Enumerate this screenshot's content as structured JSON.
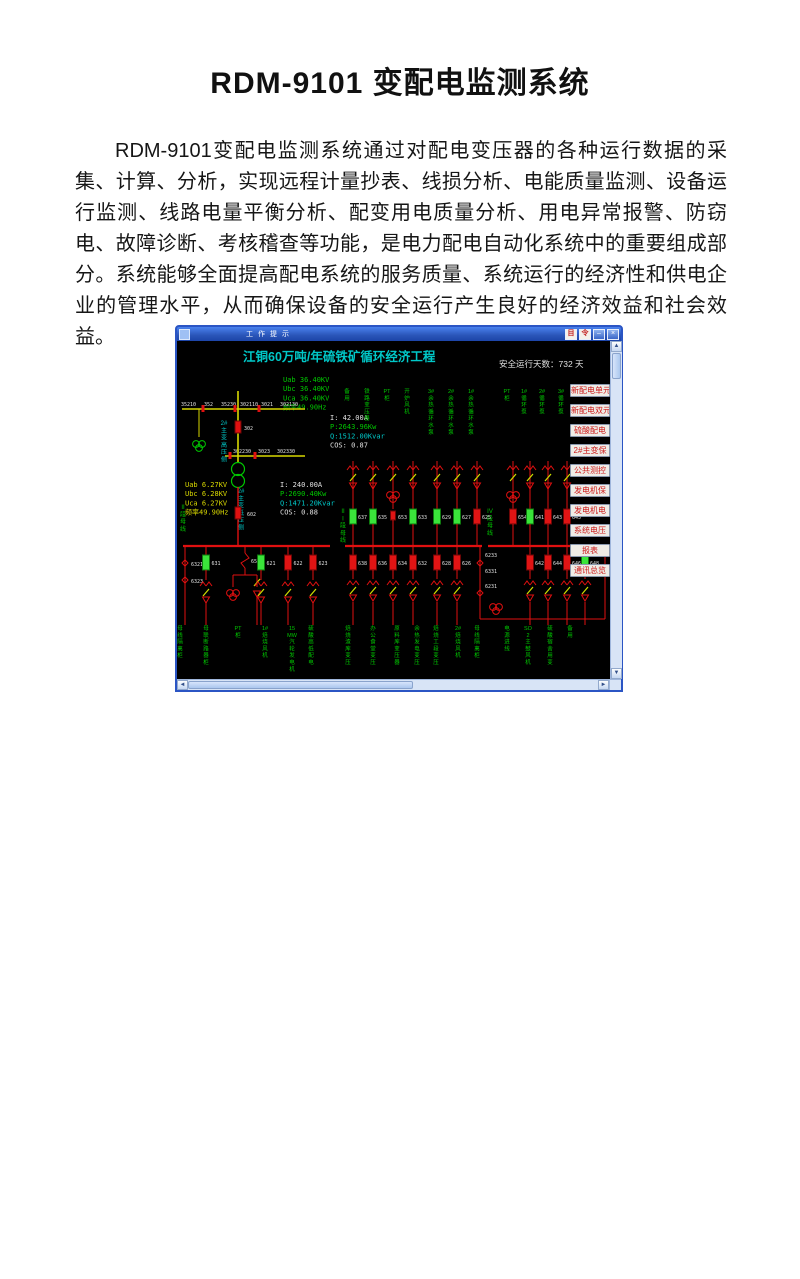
{
  "doc": {
    "title": "RDM-9101 变配电监测系统",
    "paragraph": "RDM-9101变配电监测系统通过对配电变压器的各种运行数据的采集、计算、分析，实现远程计量抄表、线损分析、电能质量监测、设备运行监测、线路电量平衡分析、配变用电质量分析、用电异常报警、防窃电、故障诊断、考核稽查等功能，是电力配电自动化系统中的重要组成部分。系统能够全面提高配电系统的服务质量、系统运行的经济性和供电企业的管理水平，从而确保设备的安全运行产生良好的经济效益和社会效益。"
  },
  "window": {
    "title": "工作提示",
    "controls": {
      "minimize": "–",
      "close": "×"
    }
  },
  "hmi": {
    "screen_title": "江铜60万吨/年硫铁矿循环经济工程",
    "safe_days": {
      "label": "安全运行天数：",
      "value": "732",
      "unit": "天"
    },
    "hv_voltages": [
      "Uab 36.40KV",
      "Ubc 36.40KV",
      "Uca 36.40KV",
      "频率49.90Hz"
    ],
    "lv_voltages": [
      "Uab 6.27KV",
      "Ubc 6.28KV",
      "Uca 6.27KV",
      "频率49.90Hz"
    ],
    "hv_metrics": [
      "I:  42.00A",
      "P:2643.96Kw",
      "Q:1512.00Kvar",
      "COS:   0.87"
    ],
    "lv_metrics": [
      "I: 240.00A",
      "P:2690.40Kw",
      "Q:1471.20Kvar",
      "COS:   0.88"
    ],
    "sections": {
      "s2": "II段母线",
      "s3": "III段母线",
      "s4": "IV段母线",
      "hv": "2#主变高压侧",
      "lv": "2#主变低压侧"
    },
    "codes": {
      "top": [
        "35210",
        "352",
        "35230",
        "302110",
        "3021",
        "302130"
      ],
      "mid": [
        "302230",
        "3023",
        "302330"
      ],
      "hv_breaker": "302",
      "lv_breaker": "602",
      "left": [
        "6321",
        "6323"
      ],
      "tie": [
        "6233",
        "6331",
        "6231"
      ],
      "bus_tie": "652"
    },
    "bus2_breakers": [
      {
        "id": "631",
        "color": "green"
      },
      {
        "id": "652",
        "color": "switch"
      },
      {
        "id": "621",
        "color": "green"
      },
      {
        "id": "622",
        "color": "red"
      },
      {
        "id": "623",
        "color": "red"
      }
    ],
    "bus3_top": [
      {
        "id": "637",
        "color": "green"
      },
      {
        "id": "635",
        "color": "green"
      },
      {
        "id": "653",
        "color": "red",
        "small": true
      },
      {
        "id": "633",
        "color": "green"
      },
      {
        "id": "629",
        "color": "green"
      },
      {
        "id": "627",
        "color": "green"
      },
      {
        "id": "625",
        "color": "red"
      }
    ],
    "bus4_top": [
      {
        "id": "654",
        "color": "red"
      },
      {
        "id": "641",
        "color": "green"
      },
      {
        "id": "643",
        "color": "red"
      },
      {
        "id": "645",
        "color": "red"
      }
    ],
    "bus3_bottom": [
      {
        "id": "638",
        "color": "red"
      },
      {
        "id": "636",
        "color": "red"
      },
      {
        "id": "634",
        "color": "red"
      },
      {
        "id": "632",
        "color": "red"
      },
      {
        "id": "628",
        "color": "red"
      },
      {
        "id": "626",
        "color": "red"
      }
    ],
    "bus4_bottom": [
      {
        "id": "642",
        "color": "red"
      },
      {
        "id": "644",
        "color": "red"
      },
      {
        "id": "646",
        "color": "red"
      },
      {
        "id": "648",
        "color": "green"
      }
    ],
    "top_feeders": [
      "备用",
      "铁路变压器",
      "PT柜",
      "开炉风机",
      "3#余热循环水泵",
      "2#余热循环水泵",
      "1#余热循环水泵",
      "PT柜",
      "1#循环泵",
      "2#循环泵",
      "3#循环泵"
    ],
    "bottom_feeders": [
      "母线隔离柜",
      "母联断路器柜",
      "PT柜",
      "1#焙烧风机",
      "15MW汽轮发电机",
      "硫酸高低配电",
      "焙烧渣库变压",
      "办公食堂变压",
      "原料库变压器",
      "余热发电变压",
      "焙烧工段变压",
      "2#焙烧风机",
      "母线隔离柜",
      "电源进线",
      "SO2主鼓风机",
      "硫酸宿舍用变",
      "备用"
    ],
    "side_buttons": [
      "新配电单元",
      "新配电双元",
      "硫酸配电",
      "2#主变保",
      "公共测控",
      "发电机保",
      "发电机电",
      "系统电压",
      "报表",
      "通讯总览"
    ],
    "colors": {
      "red": "#e01010",
      "green": "#00c800",
      "yellow": "#d8d800",
      "cyan": "#00c8c8",
      "white": "#e0e0e0"
    }
  }
}
